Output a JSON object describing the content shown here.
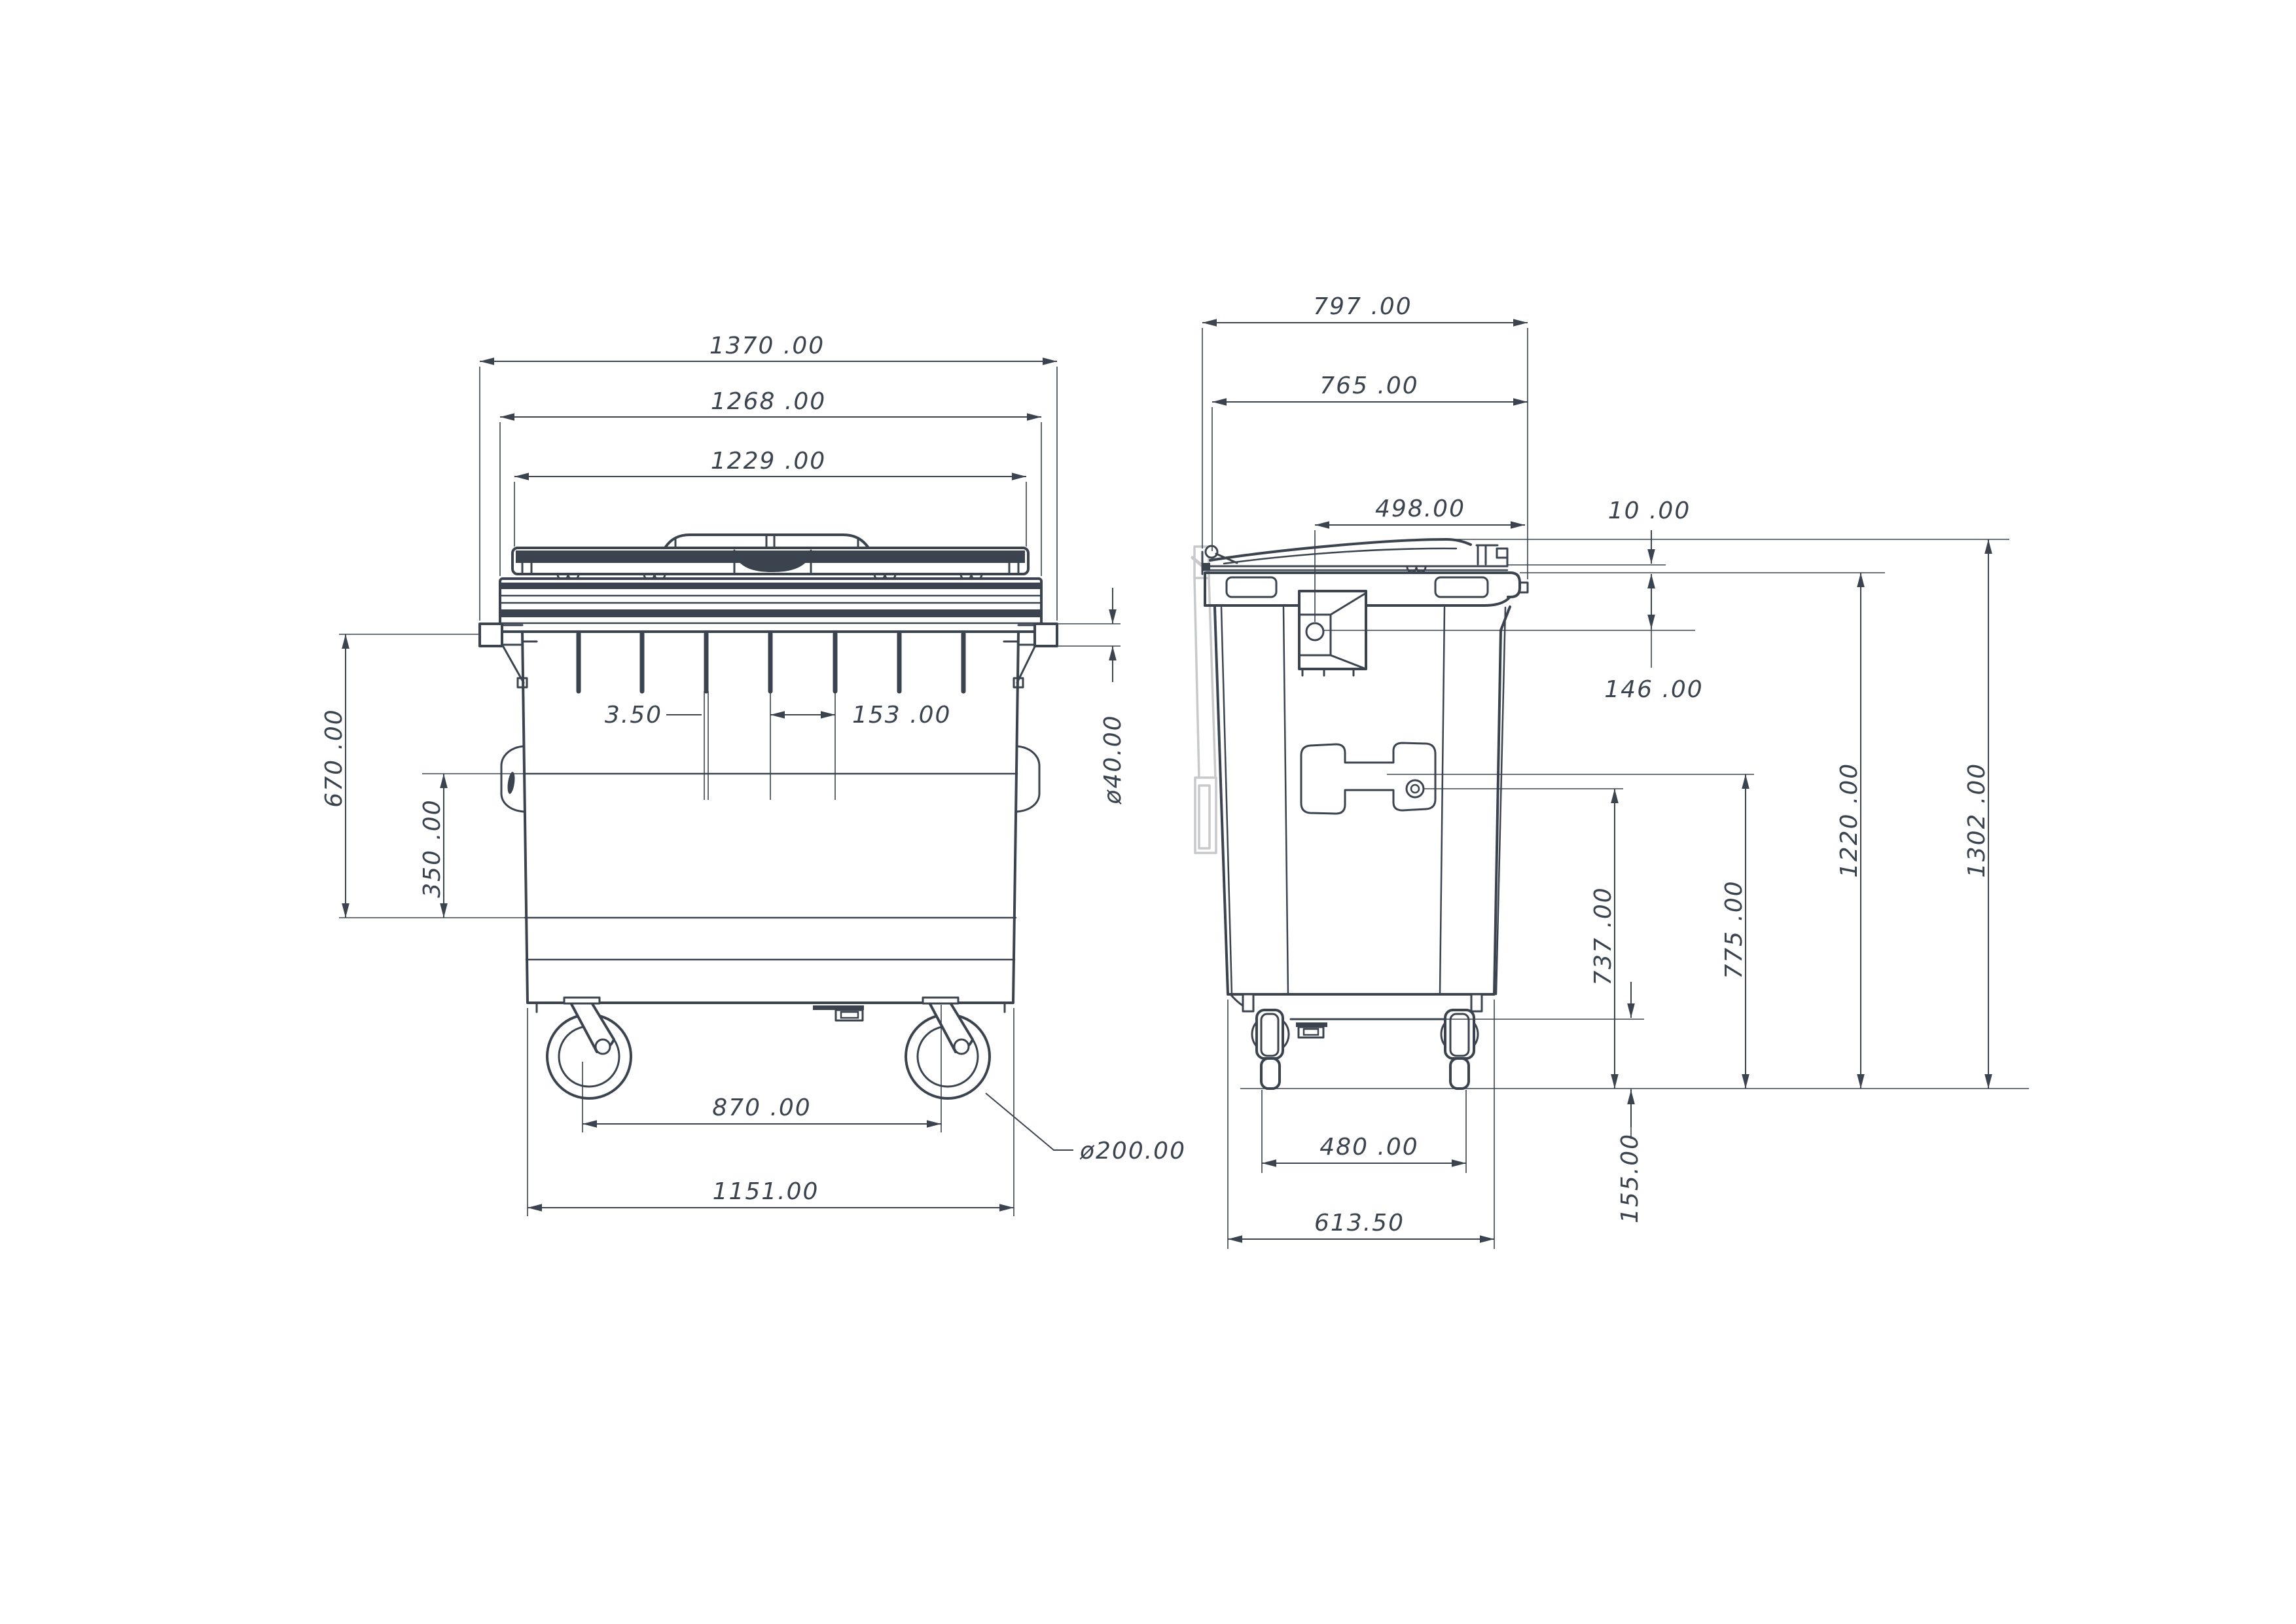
{
  "document": {
    "type": "technical-drawing",
    "subject": "four-wheel waste container, front and side orthographic views with dimensions",
    "views": [
      "front",
      "side"
    ]
  },
  "colors": {
    "ink": "#3A434E",
    "ghost_gray": "#C7C9CA",
    "background": "#FFFFFF"
  },
  "dims": {
    "front": {
      "w1370": "1370 .00",
      "w1268": "1268 .00",
      "w1229": "1229 .00",
      "h670": "670 .00",
      "h350": "350 .00",
      "rib_thickness": "3.50",
      "rib_spacing": "153 .00",
      "trunnion_bar": "ø40.00",
      "wheel_track": "870 .00",
      "base_width": "1151.00",
      "wheel_diameter": "ø200.00"
    },
    "side": {
      "d797": "797 .00",
      "d765": "765 .00",
      "d498": "498.00",
      "gap10": "10 .00",
      "h146": "146 .00",
      "h1220": "1220 .00",
      "h1302": "1302 .00",
      "h737": "737 .00",
      "h775": "775 .00",
      "h155": "155.00",
      "track480": "480 .00",
      "base613": "613.50"
    }
  }
}
